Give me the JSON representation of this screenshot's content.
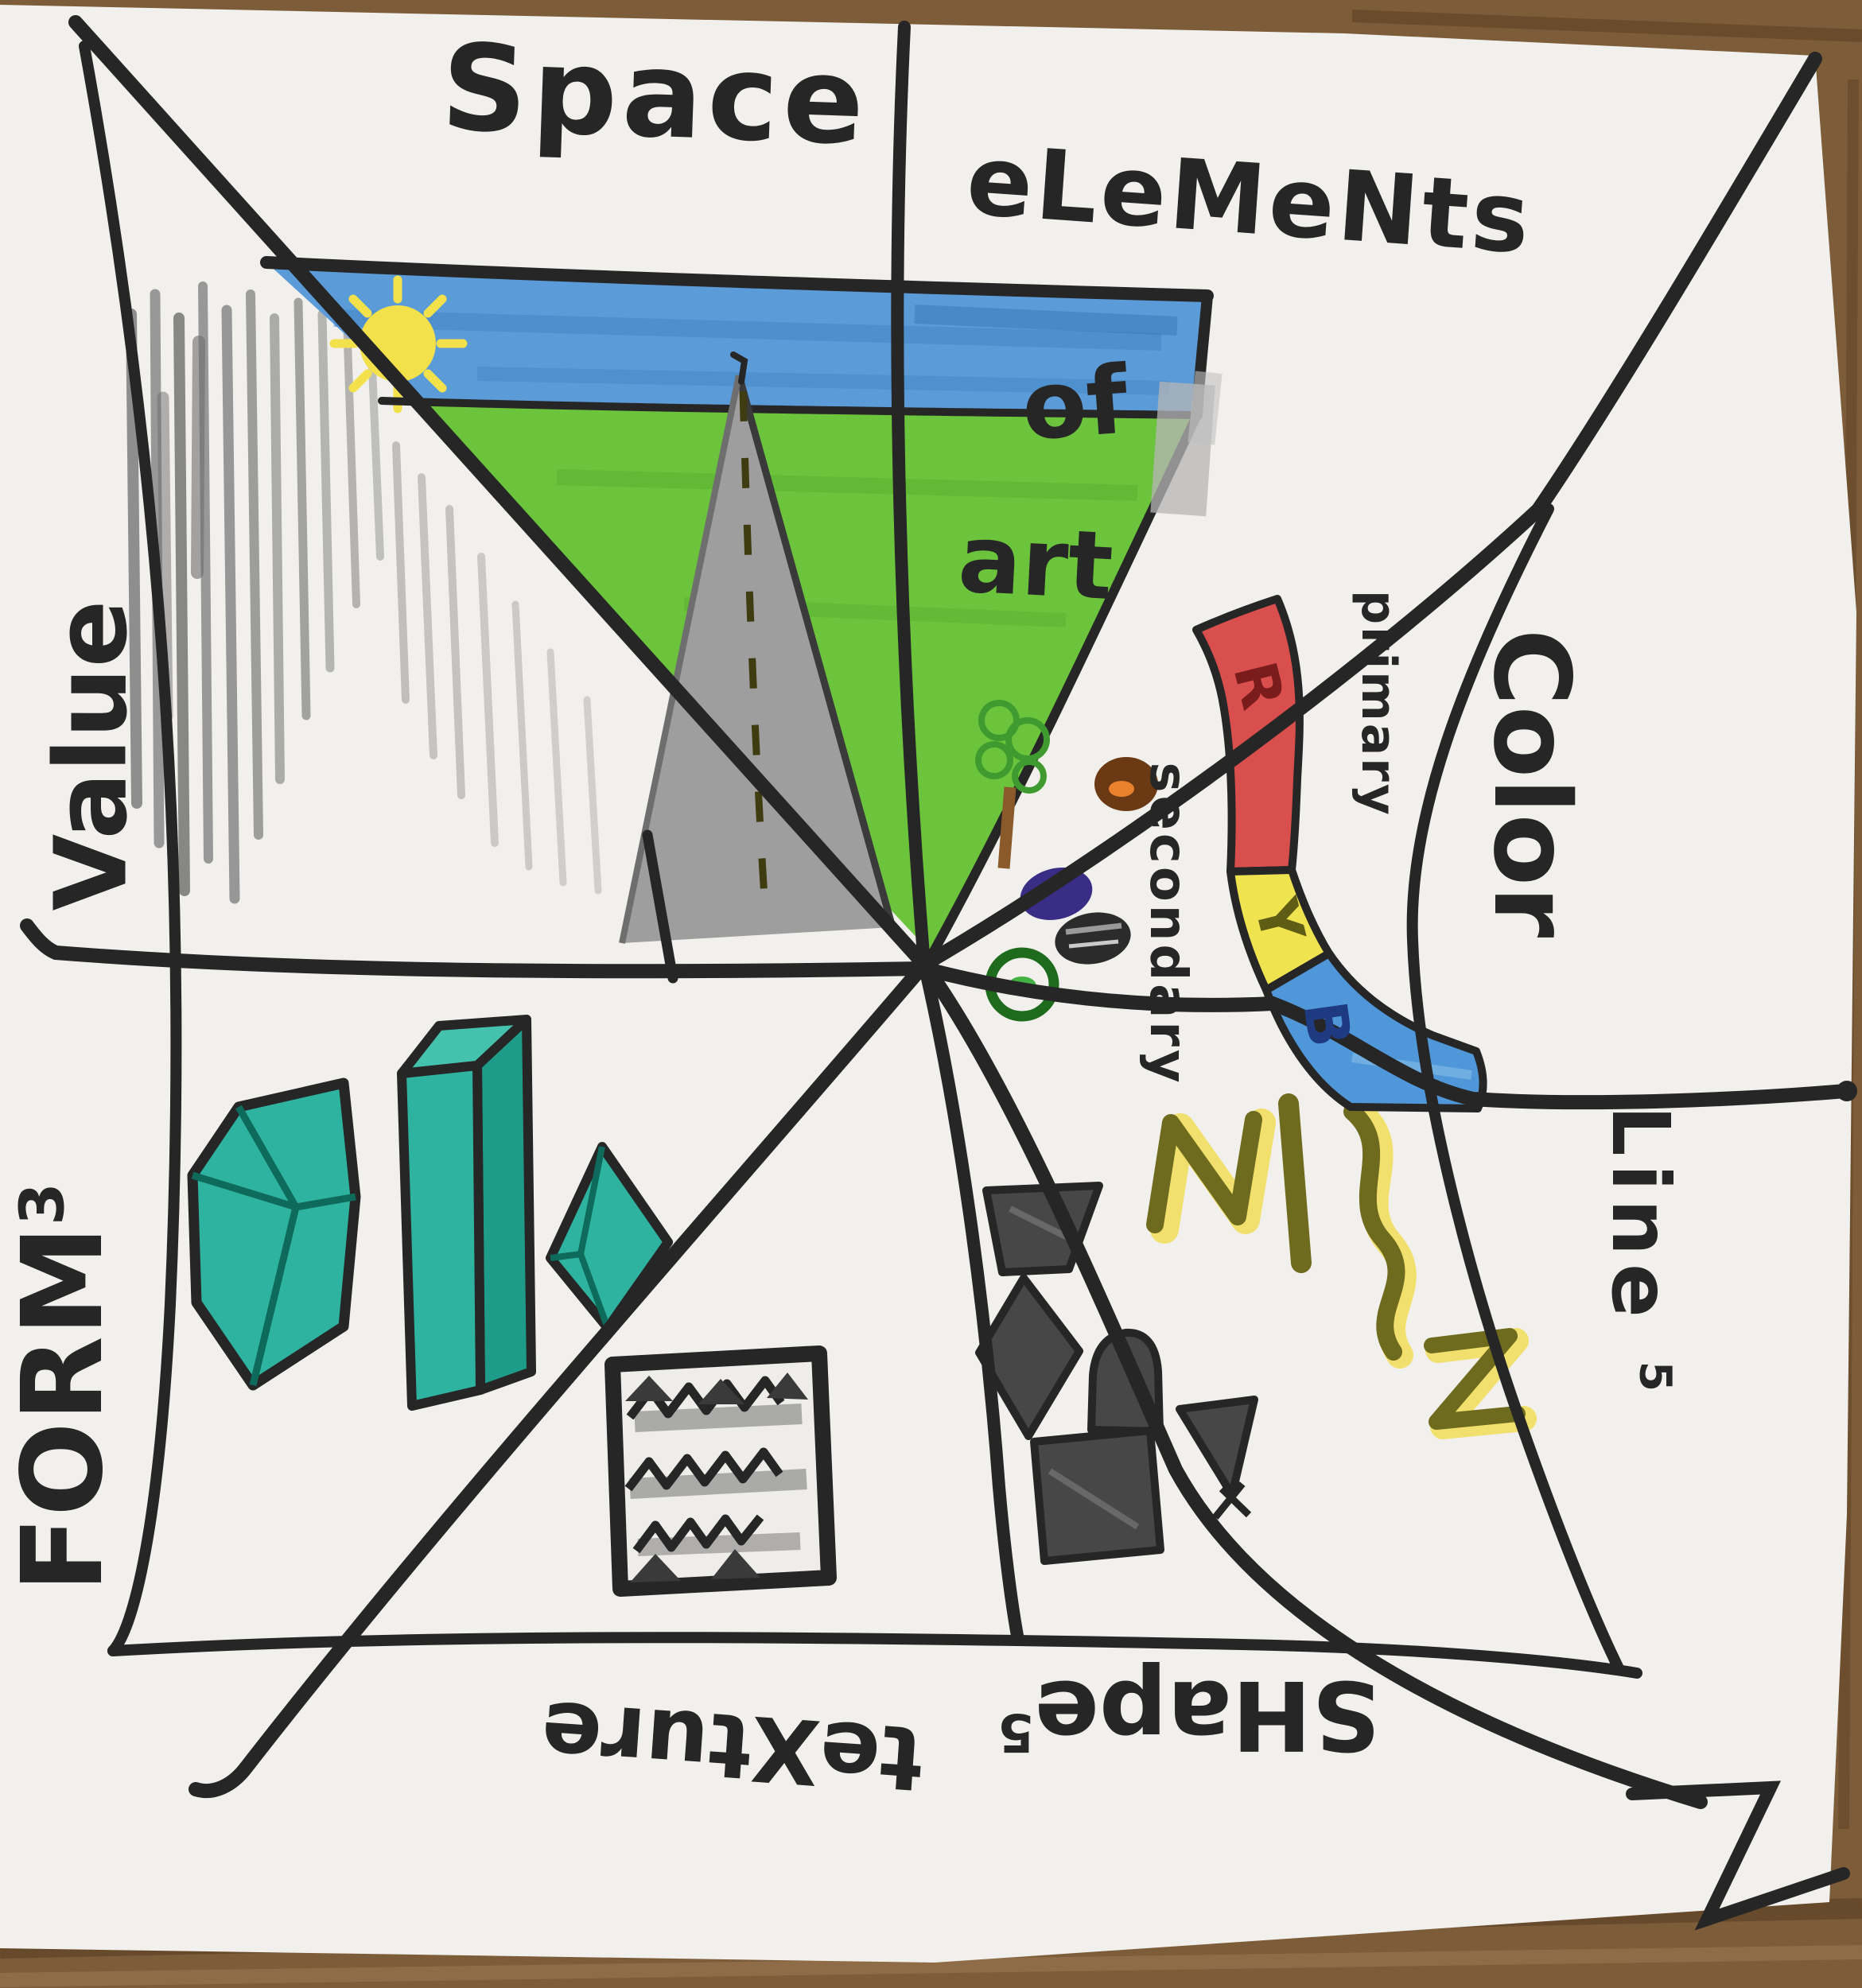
{
  "artwork": {
    "kind": "hand-drawn elements-of-art pinwheel folded-paper diagram",
    "title": {
      "line1": "eLeMeNts",
      "line2": "of",
      "line3": "art"
    },
    "sections": {
      "space": {
        "label": "Space"
      },
      "value": {
        "label": "Value"
      },
      "form": {
        "label": "FORM",
        "suffix": "3"
      },
      "texture": {
        "label": "teXture"
      },
      "shapes": {
        "label": "SHape",
        "suffix": "5"
      },
      "lines": {
        "label": "Line",
        "suffix": "5"
      },
      "color": {
        "label": "Color",
        "primary_label": "primary",
        "secondary_label": "secondary",
        "bands": [
          {
            "letter": "R",
            "color": "#d94f4d"
          },
          {
            "letter": "Y",
            "color": "#efe44f"
          },
          {
            "letter": "B",
            "color": "#4f97d9"
          }
        ],
        "dot_colors": [
          "brown-orange",
          "purple",
          "black",
          "green"
        ]
      }
    },
    "palette": {
      "ink": "#262626",
      "paper": "#f2f0ec",
      "wood": "#7d5c3a",
      "sky_blue": "#5b9bd8",
      "grass_green": "#6cc43d",
      "sun_yellow": "#f3e14c",
      "road_gray": "#9e9e9e",
      "form_teal": "#2fb3a1",
      "pencil_gray": "#8f8f8f",
      "line_olive": "#6e6b1e",
      "highlighter_yellow": "#f0dc4e"
    }
  }
}
